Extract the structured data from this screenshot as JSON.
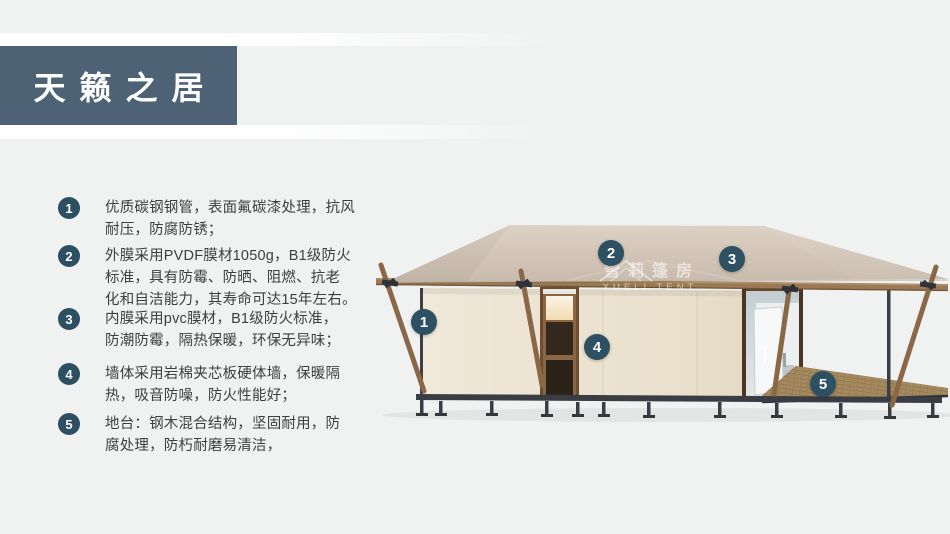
{
  "header": {
    "title": "天籁之居",
    "box_color": "#4d6275",
    "text_color": "#ffffff"
  },
  "features": {
    "badge_color": "#2d4f62",
    "items": [
      {
        "num": "1",
        "text": "优质碳钢钢管，表面氟碳漆处理，抗风\n耐压，防腐防锈；"
      },
      {
        "num": "2",
        "text": "外膜采用PVDF膜材1050g，B1级防火\n标准，具有防霉、防晒、阻燃、抗老\n化和自洁能力，其寿命可达15年左右。"
      },
      {
        "num": "3",
        "text": "内膜采用pvc膜材，B1级防火标准，\n防潮防霉，隔热保暖，环保无异味；"
      },
      {
        "num": "4",
        "text": "墙体采用岩棉夹芯板硬体墙，保暖隔\n热，吸音防噪，防火性能好；"
      },
      {
        "num": "5",
        "text": "地台：钢木混合结构，坚固耐用，防\n腐处理，防朽耐磨易清洁，"
      }
    ]
  },
  "diagram": {
    "markers": [
      {
        "label": "1"
      },
      {
        "label": "2"
      },
      {
        "label": "3"
      },
      {
        "label": "4"
      },
      {
        "label": "5"
      }
    ],
    "marker_color": "#2e5063",
    "watermark": {
      "cn": "雪莉篷房",
      "en": "XUELI TENT"
    },
    "colors": {
      "roof": "#d3c6b8",
      "wall": "#ebe2d0",
      "wood": "#8a6746",
      "metal": "#3a3e44",
      "deck": "#a4895f"
    }
  }
}
